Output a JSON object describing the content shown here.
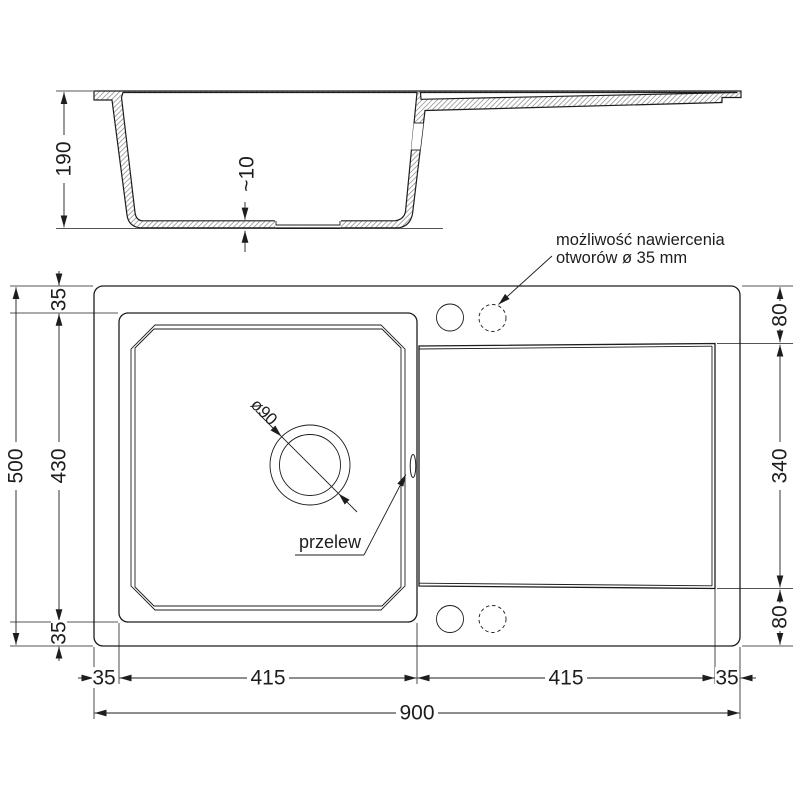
{
  "drawing": {
    "title": "sink-technical-drawing",
    "colors": {
      "line": "#1d1d1b",
      "hatch": "#6e6e6e",
      "background": "#ffffff"
    },
    "side_view": {
      "depth": "190",
      "bottom_thickness": "~10"
    },
    "top_view": {
      "left_dims": {
        "total_height": "500",
        "bowl_height": "430",
        "margin_top": "35",
        "margin_bottom": "35"
      },
      "right_dims": {
        "top_margin": "80",
        "drainer_height": "340",
        "bottom_margin": "80"
      },
      "bottom_dims": {
        "margin_left": "35",
        "bowl_width": "415",
        "drainer_width": "415",
        "margin_right": "35",
        "total_width": "900"
      },
      "drain_diameter_label": "ø90",
      "overflow_label": "przelew",
      "holes_note_line1": "możliwość nawiercenia",
      "holes_note_line2": "otworów ø 35 mm"
    }
  }
}
